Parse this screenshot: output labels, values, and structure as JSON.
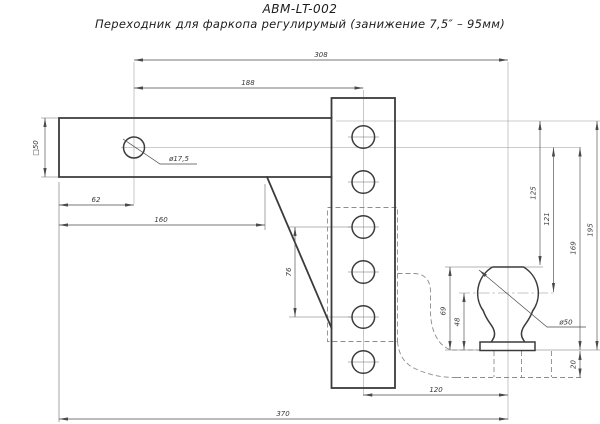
{
  "title": "ABM-LT-002",
  "subtitle": "Переходник для фаркопа регулирумый (занижение 7,5″ – 95мм)",
  "dimensions": {
    "shank_hole_to_ball_center": "308",
    "shank_hole_to_column_center": "188",
    "shank_end_to_hole": "62",
    "shank_end_to_brace": "160",
    "shank_square_section": "□50",
    "shank_hole_diameter": "ø17,5",
    "column_hole_span": "76",
    "overall_length": "370",
    "column_to_ball_center": "120",
    "shank_top_to_ball_top": "125",
    "shank_center_to_ball_center": "121",
    "shank_center_to_plate": "169",
    "shank_top_to_plate": "195",
    "ball_overall_height": "69",
    "ball_center_height": "48",
    "plate_thickness": "20",
    "ball_diameter": "ø50"
  }
}
